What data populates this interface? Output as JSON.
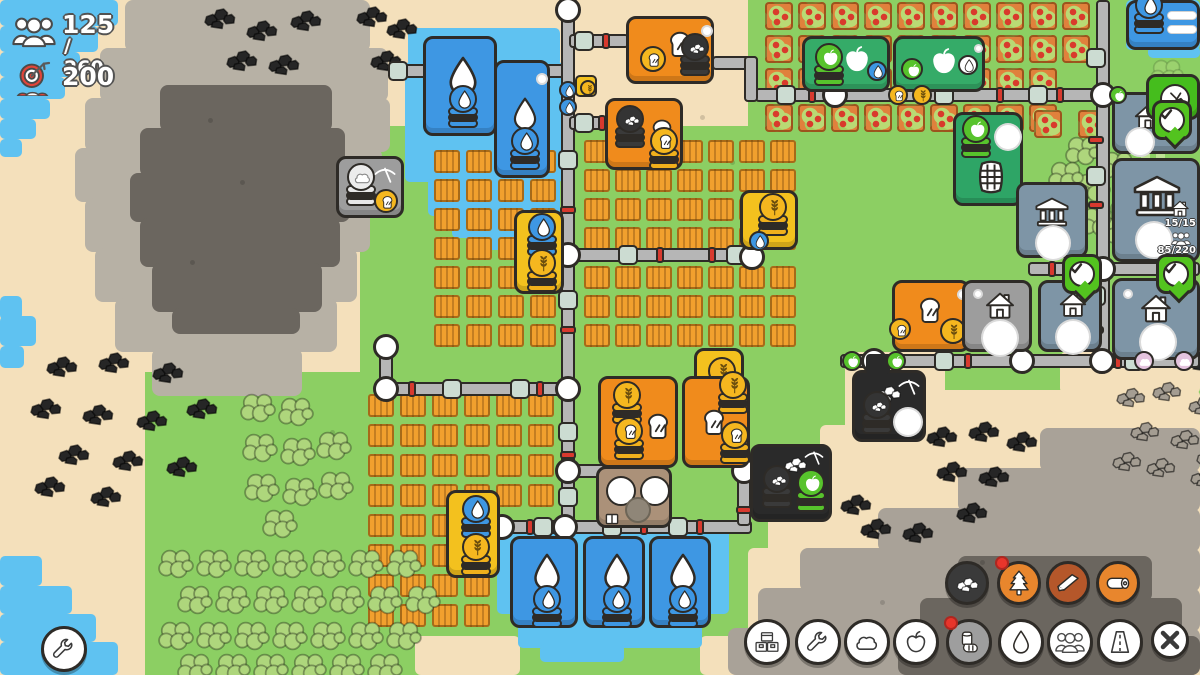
{
  "hud": {
    "population": {
      "icon": "people-icon",
      "current": "125",
      "capacity": "/ 260"
    },
    "goal": {
      "icon": "target-icon",
      "value": "200"
    }
  },
  "building_labels": {
    "houses_icon": "house-icon",
    "houses": "15/15",
    "residents_icon": "people-icon",
    "residents": "85/220"
  },
  "toolbar": {
    "main_buttons": [
      {
        "id": "storage",
        "icon": "crates-icon",
        "selected": false,
        "badge": false
      },
      {
        "id": "tools",
        "icon": "wrench-icon",
        "selected": false,
        "badge": false
      },
      {
        "id": "stone",
        "icon": "rock-icon",
        "selected": false,
        "badge": false
      },
      {
        "id": "food",
        "icon": "apple-icon",
        "selected": false,
        "badge": false
      },
      {
        "id": "wood",
        "icon": "log-hand-icon",
        "selected": true,
        "badge": true
      },
      {
        "id": "water",
        "icon": "drop-icon",
        "selected": false,
        "badge": false
      },
      {
        "id": "population",
        "icon": "people-icon",
        "selected": false,
        "badge": false
      },
      {
        "id": "roads",
        "icon": "road-icon",
        "selected": false,
        "badge": false
      },
      {
        "id": "close",
        "icon": "close-icon",
        "selected": false,
        "badge": false
      }
    ],
    "submenu_buttons": [
      {
        "id": "coal",
        "icon": "coal-icon",
        "color": "#3a3a3a",
        "badge": false
      },
      {
        "id": "forester",
        "icon": "tree-icon",
        "color": "#e8862d",
        "badge": true
      },
      {
        "id": "sawmill",
        "icon": "plank-icon",
        "color": "#b5572a",
        "badge": false
      },
      {
        "id": "logging",
        "icon": "log-icon",
        "color": "#e8862d",
        "badge": false
      }
    ]
  },
  "settings_button": {
    "icon": "wrench-icon"
  },
  "map_building_types": [
    "water-collector",
    "bakery",
    "wheat-farm",
    "stone-mine",
    "coal-mine",
    "grain-mill",
    "apple-farm",
    "cider-maker",
    "house",
    "town-hall",
    "forester-hut",
    "storage"
  ],
  "colors": {
    "water": "#5fc2f1",
    "sand": "#f4e0bb",
    "grass": "#8ccf63",
    "rock_light": "#b7b1a5",
    "rock_dark": "#6b665f",
    "road": "#b6b6b6",
    "outline": "#2e2b27",
    "connector": "#ccdcd2",
    "alert_red": "#d8392e",
    "building_blue": "#3e97e3",
    "building_orange": "#f08b1c",
    "building_yellow": "#f3c11e",
    "building_gray": "#9d9d9d",
    "building_steel": "#7e95a6",
    "building_green": "#2ea566",
    "building_black": "#2a2a2a",
    "bubble_green": "#53c31f",
    "coin_gold": "#f5b71f"
  }
}
